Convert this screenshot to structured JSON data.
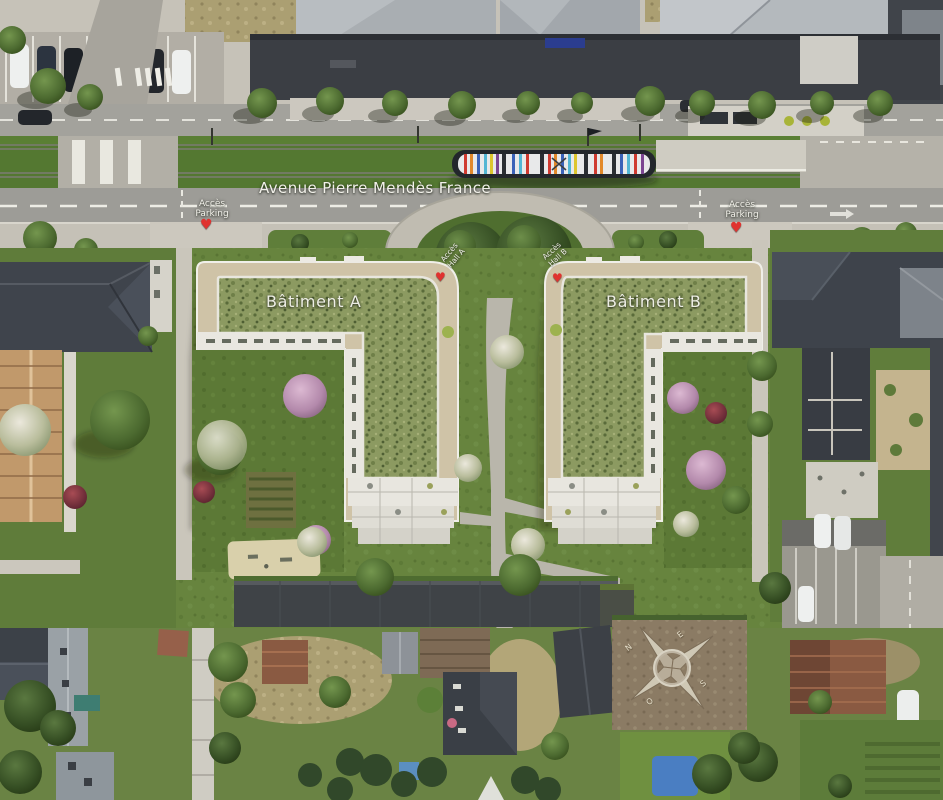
{
  "scene": {
    "kind": "aerial-development-render",
    "width": 943,
    "height": 800
  },
  "street": {
    "name": "Avenue Pierre Mendès France"
  },
  "buildings": {
    "a": {
      "label": "Bâtiment A"
    },
    "b": {
      "label": "Bâtiment B"
    }
  },
  "annotations": {
    "parking_access_left": {
      "line1": "Accès",
      "line2": "Parking"
    },
    "parking_access_right": {
      "line1": "Accès",
      "line2": "Parking"
    },
    "hall_access_a": {
      "line1": "Accès",
      "line2": "Hall A"
    },
    "hall_access_b": {
      "line1": "Accès",
      "line2": "Hall B"
    }
  },
  "compass": {
    "n": "N",
    "e": "E",
    "s": "S",
    "w": "O"
  },
  "icons": {
    "marker_glyph": "♥"
  },
  "colors": {
    "marker_red": "#e0322f",
    "green_roof": "#8c9a61",
    "lawn": "#67843e",
    "asphalt": "#9d9c97",
    "sidewalk": "#c5c1b7",
    "dark_roof": "#3e434b",
    "beige_parapet": "#cfc3a7",
    "white_facade": "#e9e7e0",
    "tram_grass": "#547831"
  }
}
